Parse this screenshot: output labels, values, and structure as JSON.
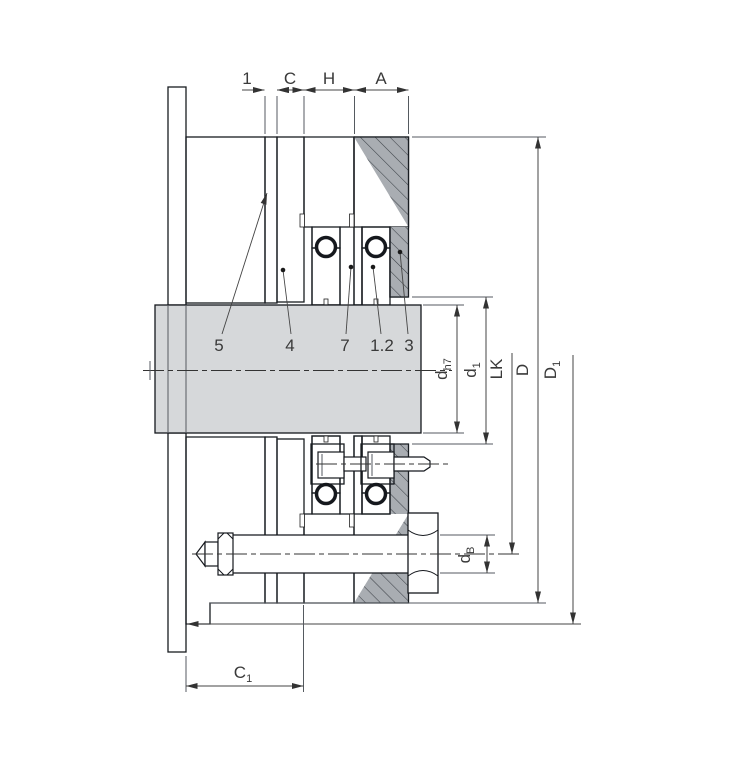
{
  "drawing": {
    "title": "mechanical-seal-installation-cross-section",
    "top_dimensions": {
      "gap": "1",
      "c": "C",
      "h": "H",
      "a": "A"
    },
    "part_labels": {
      "p5": "5",
      "p4": "4",
      "p7": "7",
      "p12": "1.2",
      "p3": "3"
    },
    "diameter_dimensions": {
      "shaft": {
        "main": "d",
        "sub": "h7"
      },
      "seat": {
        "main": "d",
        "sub": "1"
      },
      "bolt_circle": {
        "main": "LK",
        "sub": ""
      },
      "gland_od": {
        "main": "D",
        "sub": ""
      },
      "flange_od": {
        "main": "D",
        "sub": "1"
      },
      "bolt": {
        "main": "d",
        "sub": "B"
      }
    },
    "bottom_dimensions": {
      "c1": {
        "main": "C",
        "sub": "1"
      }
    },
    "colors": {
      "part_gray_fill": "#a9adb2",
      "gray_hatch_line": "#3d4248",
      "elastomer_blue_fill": "#5674b2",
      "blue_hatch_line": "#203461",
      "shaft_fill": "#d6d8da",
      "outline": "#181c21",
      "dimension_line": "#444444",
      "background": "#ffffff"
    }
  }
}
